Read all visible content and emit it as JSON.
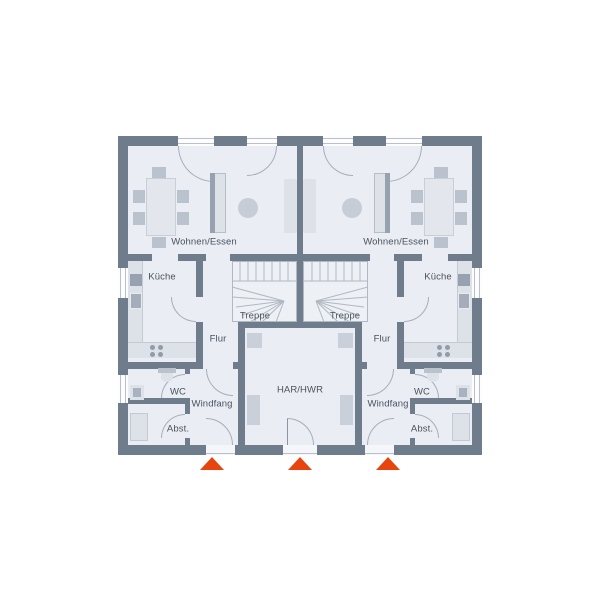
{
  "plan_title": "Erdgeschoss Doppelhaus",
  "colors": {
    "wall": "#6f7c8c",
    "floor": "#eaedf3",
    "furniture_light": "#dde2e9",
    "furniture_mid": "#bac2cd",
    "entrance_arrow": "#e8440d",
    "label_text": "#4a5360"
  },
  "units": {
    "left": {
      "living": "Wohnen/Essen",
      "kitchen": "Küche",
      "stairs": "Treppe",
      "hall": "Flur",
      "wc": "WC",
      "vestibule": "Windfang",
      "storage": "Abst."
    },
    "right": {
      "living": "Wohnen/Essen",
      "kitchen": "Küche",
      "stairs": "Treppe",
      "hall": "Flur",
      "wc": "WC",
      "vestibule": "Windfang",
      "storage": "Abst."
    },
    "shared": {
      "utility": "HAR/HWR"
    }
  }
}
